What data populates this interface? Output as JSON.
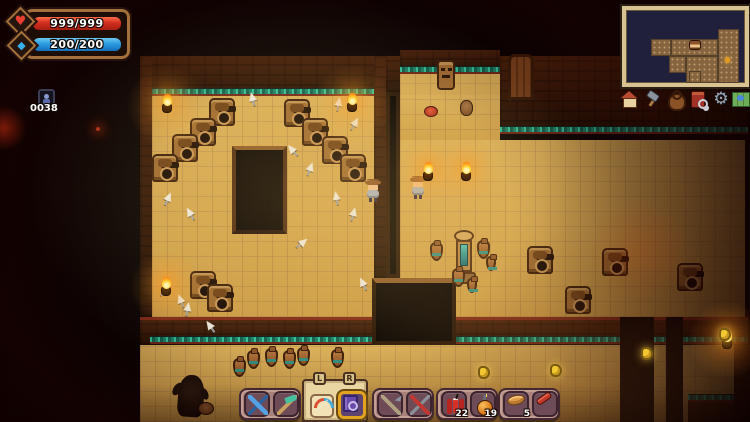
{
  "hud": {
    "health": {
      "value": "999/999",
      "icon": "heart",
      "color": "#d22f1e"
    },
    "mana": {
      "value": "200/200",
      "icon": "diamond",
      "color": "#2b9be0"
    },
    "counter": {
      "value": "0038",
      "icon": "player-portrait"
    }
  },
  "minimap": {
    "player_icon": "player-head",
    "marker_color": "#e09a20"
  },
  "menu": {
    "items": [
      {
        "name": "home"
      },
      {
        "name": "craft-hammer"
      },
      {
        "name": "inventory-bag"
      },
      {
        "name": "journal"
      },
      {
        "name": "settings-gear"
      },
      {
        "name": "world-map"
      }
    ]
  },
  "hotbar": {
    "groups": [
      {
        "slots": [
          {
            "item": "crossbow"
          },
          {
            "item": "scythe"
          }
        ]
      },
      {
        "slots": [
          {
            "item": "bow",
            "binding": "L"
          },
          {
            "item": "spell-tome",
            "binding": "R",
            "selected": true
          }
        ]
      },
      {
        "slots": [
          {
            "item": "hookshot"
          },
          {
            "item": "shears"
          }
        ]
      },
      {
        "slots": [
          {
            "item": "dynamite",
            "count": "22"
          },
          {
            "item": "bomb",
            "count": "19"
          }
        ]
      },
      {
        "slots": [
          {
            "item": "bread",
            "count": "5"
          },
          {
            "item": "jerky"
          }
        ]
      }
    ]
  },
  "world": {
    "glyphs": {
      "heart": "♥",
      "diamond": "◆",
      "gear": "⚙"
    }
  }
}
